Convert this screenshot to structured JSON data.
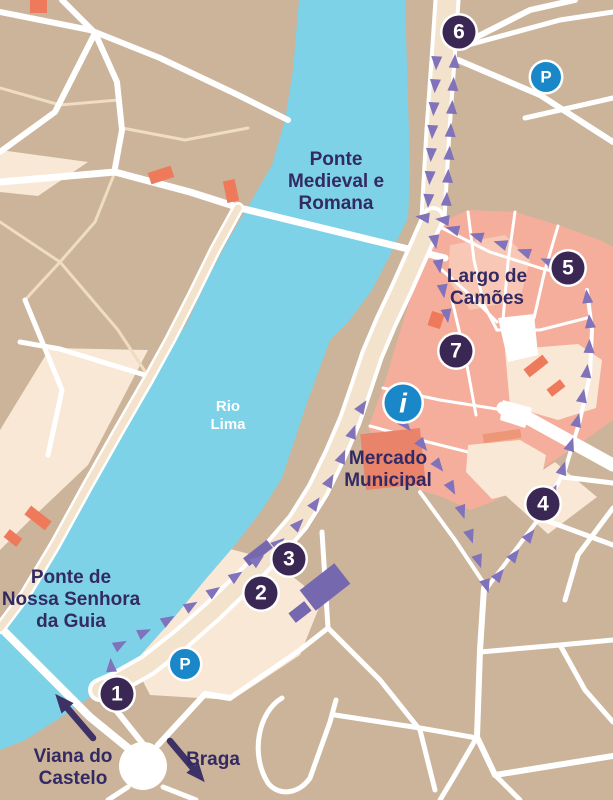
{
  "colors": {
    "background": "#CBB49A",
    "water": "#7DD2E7",
    "road_major": "#FFFFFF",
    "road_minor": "#EFDCC2",
    "street_fill": "#F4E3CC",
    "block_cream": "#F9E8D6",
    "old_town": "#F5AE9B",
    "old_town_light": "#F8C7B5",
    "building_red": "#EF7A5B",
    "building_salmon": "#E9836A",
    "building_salmon_light": "#EE9678",
    "building_purple": "#7568AE",
    "route": "#8172BC",
    "marker": "#3B2754",
    "marker_ring": "#FFFFFF",
    "poi_blue": "#1A87C8",
    "label_text": "#332963",
    "water_label": "#FFFFFF",
    "exit_arrow": "#3E3166"
  },
  "stops": [
    {
      "number": "1",
      "x": 117,
      "y": 694
    },
    {
      "number": "2",
      "x": 261,
      "y": 593
    },
    {
      "number": "3",
      "x": 289,
      "y": 559
    },
    {
      "number": "4",
      "x": 543,
      "y": 504
    },
    {
      "number": "5",
      "x": 568,
      "y": 268
    },
    {
      "number": "6",
      "x": 459,
      "y": 32
    },
    {
      "number": "7",
      "x": 456,
      "y": 351
    }
  ],
  "parking": {
    "label": "P",
    "locations": [
      {
        "x": 546,
        "y": 77
      },
      {
        "x": 185,
        "y": 664
      }
    ]
  },
  "info_point": {
    "label": "i",
    "x": 403,
    "y": 403
  },
  "labels": [
    {
      "id": "ponte-medieval-romana",
      "lines": [
        "Ponte",
        "Medieval e",
        "Romana"
      ],
      "x": 336,
      "y": 165,
      "size": 19,
      "style": "land"
    },
    {
      "id": "largo-de-camoes",
      "lines": [
        "Largo de",
        "Camões"
      ],
      "x": 487,
      "y": 282,
      "size": 19,
      "style": "land"
    },
    {
      "id": "mercado-municipal",
      "lines": [
        "Mercado",
        "Municipal"
      ],
      "x": 388,
      "y": 464,
      "size": 19,
      "style": "land"
    },
    {
      "id": "ponte-nossa-senhora-da-guia",
      "lines": [
        "Ponte de",
        "Nossa Senhora",
        "da Guia"
      ],
      "x": 71,
      "y": 583,
      "size": 19,
      "style": "land"
    },
    {
      "id": "rio-lima",
      "lines": [
        "Rio",
        "Lima"
      ],
      "x": 228,
      "y": 411,
      "size": 15,
      "style": "water"
    }
  ],
  "exits": [
    {
      "id": "viana-do-castelo",
      "lines": [
        "Viana do",
        "Castelo"
      ],
      "x": 73,
      "y": 762,
      "size": 19,
      "arrow": {
        "x1": 93,
        "y1": 738,
        "x2": 63,
        "y2": 703
      }
    },
    {
      "id": "braga",
      "lines": [
        "Braga"
      ],
      "x": 213,
      "y": 765,
      "size": 19,
      "arrow": {
        "x1": 170,
        "y1": 741,
        "x2": 197,
        "y2": 773
      }
    }
  ],
  "route": {
    "segments": [
      {
        "id": "stop1-to-mercado",
        "spacing": 27,
        "points": [
          [
            112,
            678
          ],
          [
            110,
            650
          ],
          [
            132,
            638
          ],
          [
            158,
            626
          ],
          [
            184,
            610
          ],
          [
            210,
            594
          ],
          [
            236,
            576
          ],
          [
            262,
            557
          ],
          [
            287,
            536
          ],
          [
            308,
            514
          ],
          [
            326,
            488
          ],
          [
            340,
            462
          ],
          [
            352,
            434
          ],
          [
            362,
            407
          ],
          [
            373,
            390
          ]
        ]
      },
      {
        "id": "info-to-south-junction",
        "spacing": 26,
        "points": [
          [
            398,
            416
          ],
          [
            420,
            442
          ],
          [
            442,
            470
          ],
          [
            458,
            500
          ],
          [
            470,
            535
          ],
          [
            480,
            565
          ],
          [
            487,
            588
          ]
        ]
      },
      {
        "id": "junction-to-stop5",
        "spacing": 25,
        "points": [
          [
            492,
            584
          ],
          [
            514,
            556
          ],
          [
            534,
            530
          ],
          [
            549,
            502
          ],
          [
            561,
            474
          ],
          [
            571,
            444
          ],
          [
            579,
            414
          ],
          [
            585,
            384
          ],
          [
            589,
            354
          ],
          [
            590,
            324
          ],
          [
            587,
            296
          ],
          [
            577,
            276
          ]
        ]
      },
      {
        "id": "stop5-to-largo",
        "spacing": 25,
        "points": [
          [
            558,
            266
          ],
          [
            530,
            254
          ],
          [
            502,
            244
          ],
          [
            474,
            235
          ],
          [
            448,
            228
          ]
        ]
      },
      {
        "id": "largo-to-bridge-spur",
        "spacing": 20,
        "points": [
          [
            452,
            221
          ],
          [
            428,
            218
          ],
          [
            404,
            215
          ]
        ]
      },
      {
        "id": "quay-up-to-stop6",
        "spacing": 23,
        "points": [
          [
            446,
            210
          ],
          [
            449,
            158
          ],
          [
            452,
            106
          ],
          [
            455,
            56
          ]
        ]
      },
      {
        "id": "stop6-return-down",
        "spacing": 23,
        "points": [
          [
            437,
            52
          ],
          [
            434,
            104
          ],
          [
            431,
            156
          ],
          [
            428,
            208
          ]
        ]
      },
      {
        "id": "junction-to-stop7",
        "spacing": 25,
        "points": [
          [
            433,
            230
          ],
          [
            438,
            260
          ],
          [
            443,
            290
          ],
          [
            447,
            316
          ],
          [
            450,
            334
          ]
        ]
      }
    ]
  }
}
